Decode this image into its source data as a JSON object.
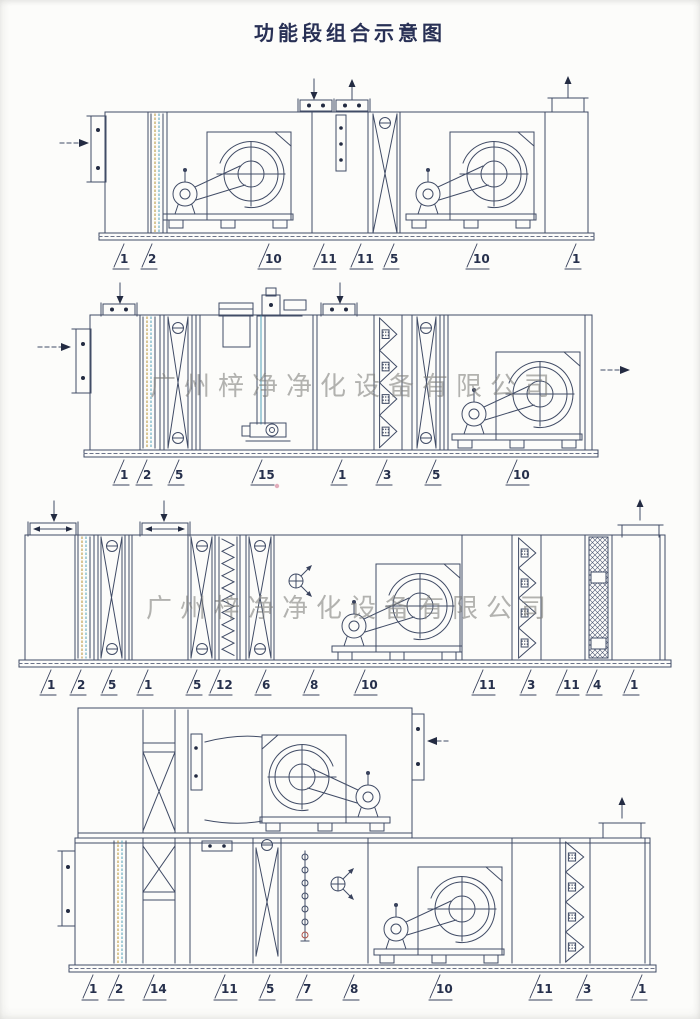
{
  "page": {
    "title": "功能段组合示意图",
    "watermark": "广州梓净净化设备有限公司"
  },
  "diagrams": [
    {
      "labels": [
        "1",
        "2",
        "10",
        "11",
        "11",
        "5",
        "10",
        "1"
      ]
    },
    {
      "labels": [
        "1",
        "2",
        "5",
        "15",
        "1",
        "3",
        "5",
        "10"
      ]
    },
    {
      "labels": [
        "1",
        "2",
        "5",
        "1",
        "5",
        "12",
        "6",
        "8",
        "10",
        "11",
        "3",
        "11",
        "4",
        "1"
      ]
    },
    {
      "labels": [
        "1",
        "2",
        "14",
        "11",
        "5",
        "7",
        "8",
        "10",
        "11",
        "3",
        "1"
      ]
    }
  ]
}
